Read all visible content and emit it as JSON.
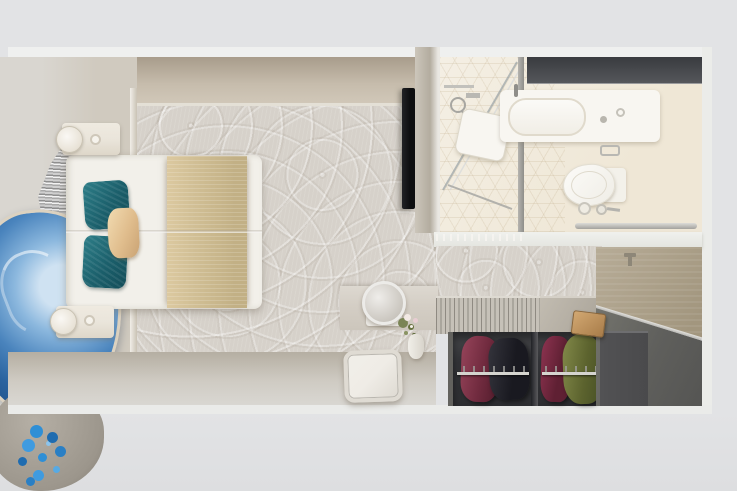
{
  "scene": {
    "type": "3d-render-top-view",
    "subject": "cruise-cabin-stateroom-floorplan",
    "rooms": [
      "bedroom",
      "bathroom",
      "wardrobe",
      "entry"
    ]
  },
  "palette": {
    "outer": "#e2e3e5",
    "outer-bottom": "#dddee0",
    "wall-trim": "#eff0ef",
    "wall-tan-dark": "#a89c8b",
    "wall-tan": "#c6bcac",
    "wall-tan-light": "#d2c9ba",
    "baseboard": "#e8e4da",
    "left-wall-face": "#d0cabf",
    "carpet-base": "#d6d1ca",
    "mattress": "#f2f0ea",
    "spread-gold": "#d2c096",
    "spread-gold-dark": "#c2b085",
    "pillow-teal": "#1b5f6b",
    "pillow-teal-light": "#2e7e88",
    "pillow-tan": "#e0bd8d",
    "nightstand": "#eae5db",
    "lamp-white": "#faf8f4",
    "agate-blue": "#4a84bd",
    "agate-blue-dark": "#1c4a80",
    "agate-blue-light": "#cfe2f2",
    "agate-rim": "#dcd2c0",
    "fringe-light": "#f2f2f2",
    "fringe-dark": "#8f8f8f",
    "stone-gray": "#9c968c",
    "flower-blue": "#2f8fd6",
    "flower-blue-dark": "#1f6cb0",
    "tv-black": "#0d0e10",
    "divider-wall": "#b3ac9f",
    "bath-floor": "#f4efe4",
    "bath-floor-deep": "#efe7d6",
    "mirror-dark": "#393b3f",
    "mirror-dark-light": "#55575b",
    "chrome": "#b4b3ae",
    "chrome-dark": "#8f8e8a",
    "porcelain": "#f8f6f1",
    "bath-wall": "#f0f1ed",
    "counter-slat": "#c6c1b8",
    "counter-smooth": "#b1aba0",
    "closet-dark": "#333438",
    "closet-side": "#63625e",
    "rail-chrome": "#d5d4cf",
    "garment1": "#96445a",
    "garment1-dark": "#521c2c",
    "garment2": "#35353d",
    "garment2-dark": "#191920",
    "garment3": "#8d3350",
    "garment3-dark": "#5f2033",
    "garment4": "#838a4a",
    "garment4-dark": "#454e24",
    "door-tan": "#b7ac97",
    "door-tan-dark": "#a2967e",
    "entry-floor": "#7b7b73",
    "entry-floor-dark": "#555553",
    "entry-cabinet": "#4a4a4c",
    "wood-stool": "#d2a872",
    "wood-stool-dark": "#a87c49",
    "stool-white": "#efece6",
    "stool-border": "#dfdbd3",
    "ledge": "#d4cec5"
  },
  "objects": {
    "headboard_wall": [
      "silver-fringe-art",
      "blue-agate-art",
      "stone-vase-with-blue-flowers"
    ],
    "bedroom": [
      "double-bed",
      "gold-bed-runner",
      "teal-pillows",
      "tan-pillow",
      "two-nightstands-with-lamps",
      "patterned-carpet",
      "wall-mounted-tv"
    ],
    "bathroom": [
      "glass-shower-enclosure",
      "shower-fixtures",
      "vanity-sink",
      "dark-mirror-cabinet",
      "toilet",
      "toilet-paper-holder",
      "waste-bin",
      "towel-rail",
      "hex-tile-floor"
    ],
    "wardrobe": [
      "slatted-counter-top",
      "open-closet-two-sections",
      "chrome-clothes-rails",
      "hanging-garments"
    ],
    "entry": [
      "entry-door",
      "door-handle",
      "dark-entry-floor",
      "entry-cabinet",
      "wooden-stool"
    ],
    "vanity_corner": [
      "round-makeup-mirror",
      "flower-vase",
      "white-stool"
    ]
  },
  "garment_colors": [
    "#96445a",
    "#35353d",
    "#8d3350",
    "#838a4a"
  ]
}
